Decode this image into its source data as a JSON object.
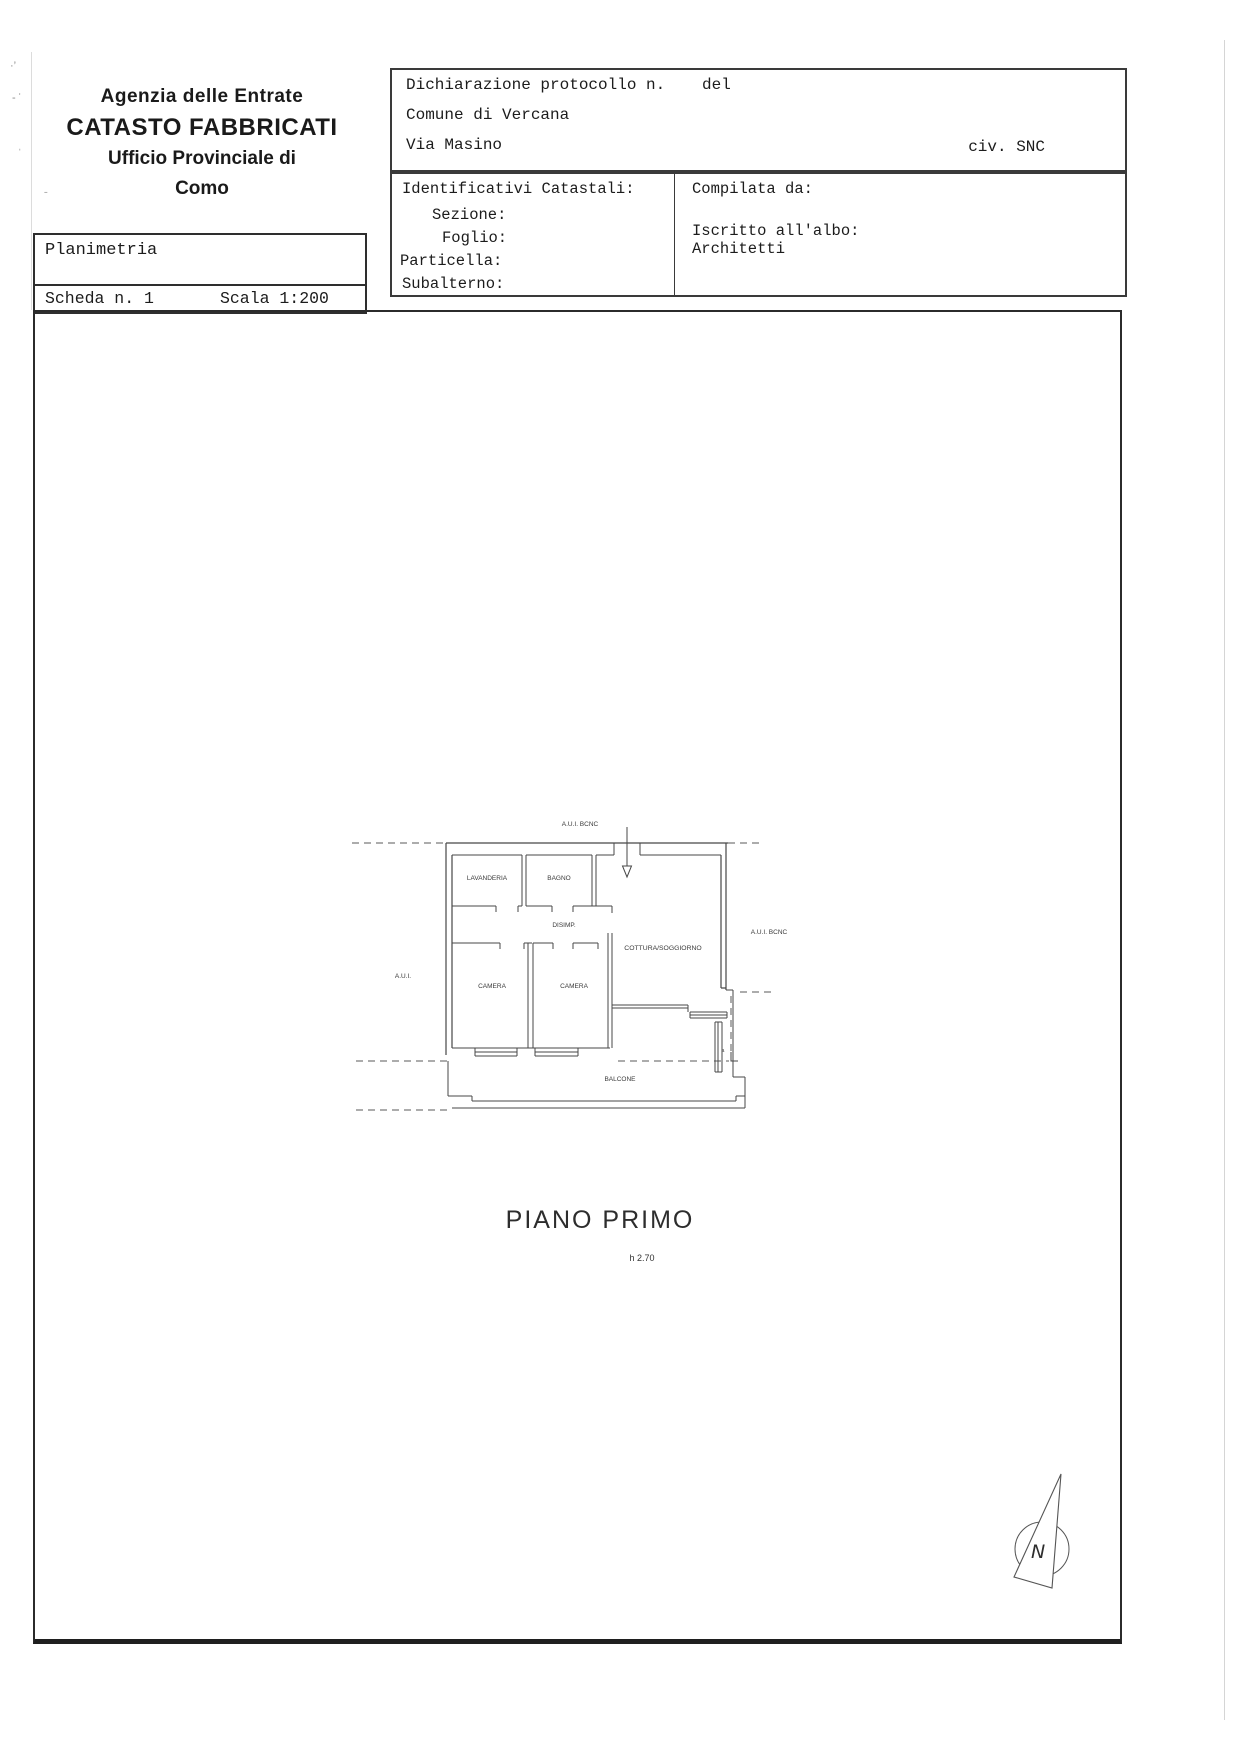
{
  "header": {
    "agency_line1": "Agenzia delle Entrate",
    "agency_line2": "CATASTO FABBRICATI",
    "agency_line3": "Ufficio Provinciale di",
    "agency_line4": "Como"
  },
  "planimetria_table": {
    "title": "Planimetria",
    "scheda": "Scheda n. 1",
    "scala": "Scala 1:200"
  },
  "declaration_box": {
    "protocol": "Dichiarazione protocollo n.",
    "del": "del",
    "comune": "Comune di Vercana",
    "via": "Via Masino",
    "civico": "civ. SNC"
  },
  "catastal_box": {
    "title": "Identificativi Catastali:",
    "sezione": "Sezione:",
    "foglio": "Foglio:",
    "particella": "Particella:",
    "subalterno": "Subalterno:",
    "compilata": "Compilata da:",
    "iscritto": "Iscritto all'albo:",
    "albo": "Architetti"
  },
  "plan": {
    "aui_bcnc_top": "A.U.I. BCNC",
    "aui_bcnc_right": "A.U.I. BCNC",
    "aui_left": "A.U.I.",
    "lavanderia": "LAVANDERIA",
    "bagno": "BAGNO",
    "disimp": "DISIMP.",
    "camera_left": "CAMERA",
    "camera_right": "CAMERA",
    "cottura": "COTTURA/SOGGIORNO",
    "balcone": "BALCONE",
    "ref_a": "a",
    "floor_title": "PIANO PRIMO",
    "height_note": "h 2.70",
    "compass_n": "N"
  }
}
